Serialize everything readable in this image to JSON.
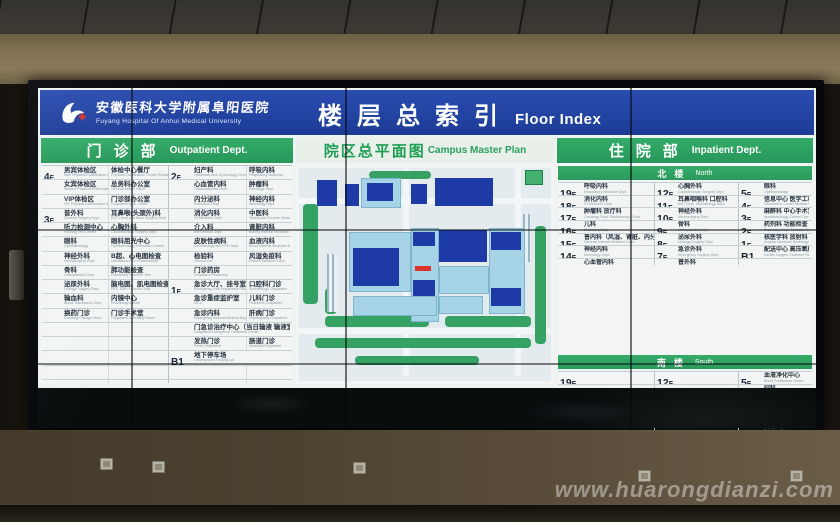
{
  "colors": {
    "header_blue": "#1c3c96",
    "section_green": "#2aa05c",
    "building_dark_blue": "#1d3aa6",
    "building_light_blue": "#a6d3e6",
    "marker_red": "#d8342a"
  },
  "watermark": "www.huarongdianzi.com",
  "board": {
    "hospital_name_zh": "安徽医科大学附属阜阳医院",
    "hospital_name_en": "Fuyang Hospital Of Anhui Medical University",
    "title_zh": "楼层总索引",
    "title_en": "Floor Index"
  },
  "outpatient": {
    "header_zh": "门诊部",
    "header_en": "Outpatient Dept.",
    "rows": [
      {
        "fa": "4F",
        "a1": [
          "男宾体检区",
          "Men Physical Examination Area"
        ],
        "a2": [
          "体检中心餐厅",
          "Physical Examination Center Restaurant"
        ],
        "fb": "2F",
        "b1": [
          "妇产科",
          "Obstetrics and Gynecology Dept."
        ],
        "b2": [
          "呼吸内科",
          "Respiratory Medicine"
        ]
      },
      {
        "fa": "",
        "a1": [
          "女宾体检区",
          "Women Physical Examination Area"
        ],
        "a2": [
          "总务科办公室",
          "General Affairs Office"
        ],
        "fb": "",
        "b1": [
          "心血管内科",
          "Cardiovascular Dept."
        ],
        "b2": [
          "肿瘤科",
          "Oncology Dept."
        ]
      },
      {
        "fa": "",
        "a1": [
          "VIP体检区",
          "VIP Physical Examination Area"
        ],
        "a2": [
          "门诊部办公室",
          "Outpatient Dept. Office"
        ],
        "fb": "",
        "b1": [
          "内分泌科",
          "Endocrine Dept."
        ],
        "b2": [
          "神经内科",
          "Neurology Dept."
        ]
      },
      {
        "fa": "3F",
        "a1": [
          "普外科",
          "General Surgery Dept."
        ],
        "a2": [
          "耳鼻喉(头颈外)科",
          "ENT Head and Neck Surgery Dept."
        ],
        "fb": "",
        "b1": [
          "消化内科",
          "GI Medicine Dept."
        ],
        "b2": [
          "中医科",
          "Traditional Chinese Medicine Dept."
        ]
      },
      {
        "fa": "",
        "a1": [
          "听力检测中心",
          "Hearing Test Center"
        ],
        "a2": [
          "心胸外科",
          "Cardiothoracic Surgery Dept."
        ],
        "fb": "",
        "b1": [
          "介入科",
          "Intervention Dept."
        ],
        "b2": [
          "肾脏内科",
          "Kidney Internal Medicine Dept."
        ]
      },
      {
        "fa": "",
        "a1": [
          "眼科",
          "Ophthalmology"
        ],
        "a2": [
          "眼科屈光中心",
          "Ophthalmology Refraction Center"
        ],
        "fb": "",
        "b1": [
          "皮肤性病科",
          "Dermatology and STD Dept."
        ],
        "b2": [
          "血液内科",
          "Blood Internal Medicine Dept."
        ]
      },
      {
        "fa": "",
        "a1": [
          "神经外科",
          "Neurosurgery Dept."
        ],
        "a2": [
          "B超、心电图检查",
          "Ultrasound ECG Examination"
        ],
        "fb": "",
        "b1": [
          "检验科",
          "Clinical Lab"
        ],
        "b2": [
          "风湿免疫科",
          "Rheum Medicine Dept."
        ]
      },
      {
        "fa": "",
        "a1": [
          "骨科",
          "Orthopaedics Dept."
        ],
        "a2": [
          "肺功能检查",
          "Pulmonary Function Test"
        ],
        "fb": "",
        "b1": [
          "门诊药房",
          "Outpatient Pharmacy"
        ],
        "b2": null
      },
      {
        "fa": "",
        "a1": [
          "泌尿外科",
          "Urology Surgery Dept."
        ],
        "a2": [
          "脑电图、肌电图检查",
          "EEG EMG Function Test"
        ],
        "fb": "1F",
        "b1": [
          "急诊大厅、挂号室",
          "Emergency Hall Registration Room"
        ],
        "b2": [
          "口腔科门诊",
          "Stomatology Outpatient"
        ]
      },
      {
        "fa": "",
        "a1": [
          "输血科",
          "Blood Transfusion Dept."
        ],
        "a2": [
          "内镜中心",
          "Endoscopy Center"
        ],
        "fb": "",
        "b1": [
          "急诊重症监护室",
          "EICU"
        ],
        "b2": [
          "儿科门诊",
          "Pediatrics Outpatient"
        ]
      },
      {
        "fa": "",
        "a1": [
          "换药门诊",
          "Dressing Change Clinic"
        ],
        "a2": [
          "门诊手术室",
          "Outpatient Operating Room"
        ],
        "fb": "",
        "b1": [
          "急诊内科",
          "Emergency Internal Medical Dept."
        ],
        "b2": [
          "肝病门诊",
          "Hepatopathy Outpatient"
        ]
      },
      {
        "fa": "",
        "a1": null,
        "a2": null,
        "fb": "",
        "b1": [
          "门急诊治疗中心（当日输液 输液室）",
          "Outpatient Emergency Treatment Center"
        ],
        "b2": null,
        "sp": true
      },
      {
        "fa": "",
        "a1": null,
        "a2": null,
        "fb": "",
        "b1": [
          "发热门诊",
          "Fever Outpatient"
        ],
        "b2": [
          "肠道门诊",
          "Intestinal Outpatient"
        ]
      },
      {
        "fa": "",
        "a1": null,
        "a2": null,
        "fb": "B1",
        "b1": [
          "地下停车场",
          "Underground Parking Lot"
        ],
        "b2": null,
        "sp": true
      },
      {
        "fa": "",
        "a1": null,
        "a2": null,
        "fb": "",
        "b1": null,
        "b2": null
      },
      {
        "fa": "",
        "a1": null,
        "a2": null,
        "fb": "",
        "b1": null,
        "b2": null
      }
    ]
  },
  "campus": {
    "header_zh": "院区总平面图",
    "header_en": "Campus Master Plan"
  },
  "inpatient": {
    "header_zh": "住院部",
    "header_en": "Inpatient Dept.",
    "north": {
      "label_zh": "北楼",
      "label_en": "North",
      "rows": [
        [
          [
            "19F",
            [
              "呼吸内科",
              "Respiratory Medicine Dept."
            ]
          ],
          [
            "12F",
            [
              "心胸外科",
              "Cardiothoracic Surgery Dept."
            ]
          ],
          [
            "5F",
            [
              "眼科",
              "Ophthalmology"
            ]
          ]
        ],
        [
          [
            "18F",
            [
              "消化内科",
              "GI Medicine Dept."
            ]
          ],
          [
            "11F",
            [
              "耳鼻咽喉科 口腔科",
              "ENT Dept. Stomatology Dept."
            ]
          ],
          [
            "4F",
            [
              "信息中心 医学工程部",
              "Information Center Medical Engineering"
            ]
          ]
        ],
        [
          [
            "17F",
            [
              "肿瘤科 放疗科",
              "Oncology Dept. Radiotherapy Dept."
            ]
          ],
          [
            "10F",
            [
              "神经外科",
              "Neurosurgery Dept."
            ]
          ],
          [
            "3F",
            [
              "麻醉科 中心手术室",
              "Anesthesiology Central Operating Room"
            ]
          ]
        ],
        [
          [
            "16F",
            [
              "儿科",
              "Pediatrics Dept."
            ]
          ],
          [
            "9F",
            [
              "骨科",
              "Orthopaedics Dept."
            ]
          ],
          [
            "2F",
            [
              "药剂科 功能检查 静配中心",
              "Pharmacy Dept. Function Test PIVAS"
            ]
          ]
        ],
        [
          [
            "15F",
            [
              "普内科（风湿、肾脏、内分泌）",
              "General Internal Medicine Dept."
            ]
          ],
          [
            "8F",
            [
              "泌尿外科",
              "Urology Surgery Dept."
            ]
          ],
          [
            "1F",
            [
              "核医学科 放射科 出入院处",
              "Nuclear Medicine Radiology Admission"
            ]
          ]
        ],
        [
          [
            "14F",
            [
              "神经内科",
              "Neurology Dept."
            ]
          ],
          [
            "7F",
            [
              "急诊外科",
              "Emergency Surgery Dept."
            ]
          ],
          [
            "B1",
            [
              "配送中心 高压氧舱 地下车库",
              "Center Oxygen Chamber Parking"
            ]
          ]
        ],
        [
          [
            "13F",
            [
              "心血管内科",
              "Cardiovascular Dept."
            ]
          ],
          [
            "6F",
            [
              "普外科",
              "General Surgery Dept."
            ]
          ],
          [
            "",
            null
          ]
        ]
      ]
    },
    "south": {
      "label_zh": "南楼",
      "label_en": "South",
      "rows": [
        [
          [
            "19F",
            null
          ],
          [
            "12F",
            null
          ],
          [
            "5F",
            [
              "血液净化中心",
              "Blood Purification Center"
            ]
          ]
        ],
        [
          [
            "18F",
            null
          ],
          [
            "11F",
            null
          ],
          [
            "4F",
            [
              "妇科",
              "Gynecology Dept."
            ]
          ]
        ],
        [
          [
            "17F",
            null
          ],
          [
            "10F",
            null
          ],
          [
            "3F",
            [
              "重症医学科(ICU)",
              "Intensive Care Unit"
            ]
          ]
        ],
        [
          [
            "16F",
            null
          ],
          [
            "9F",
            null
          ],
          [
            "2F",
            [
              "产科 产房 新生儿科",
              "Obstetrics Delivery Room Neonatal"
            ]
          ]
        ],
        [
          [
            "15F",
            null
          ],
          [
            "8F",
            null
          ],
          [
            "1F",
            [
              "病理科",
              "Pathology Dept."
            ]
          ]
        ],
        [
          [
            "14F",
            null
          ],
          [
            "7F",
            null
          ],
          [
            "B1",
            [
              "地下停车场",
              "Underground Parking Lot"
            ]
          ]
        ],
        [
          [
            "13F",
            null
          ],
          [
            "6F",
            [
              "老年内科",
              "Elderly Internal Medicine Dept."
            ]
          ],
          [
            "",
            null
          ]
        ]
      ]
    }
  }
}
